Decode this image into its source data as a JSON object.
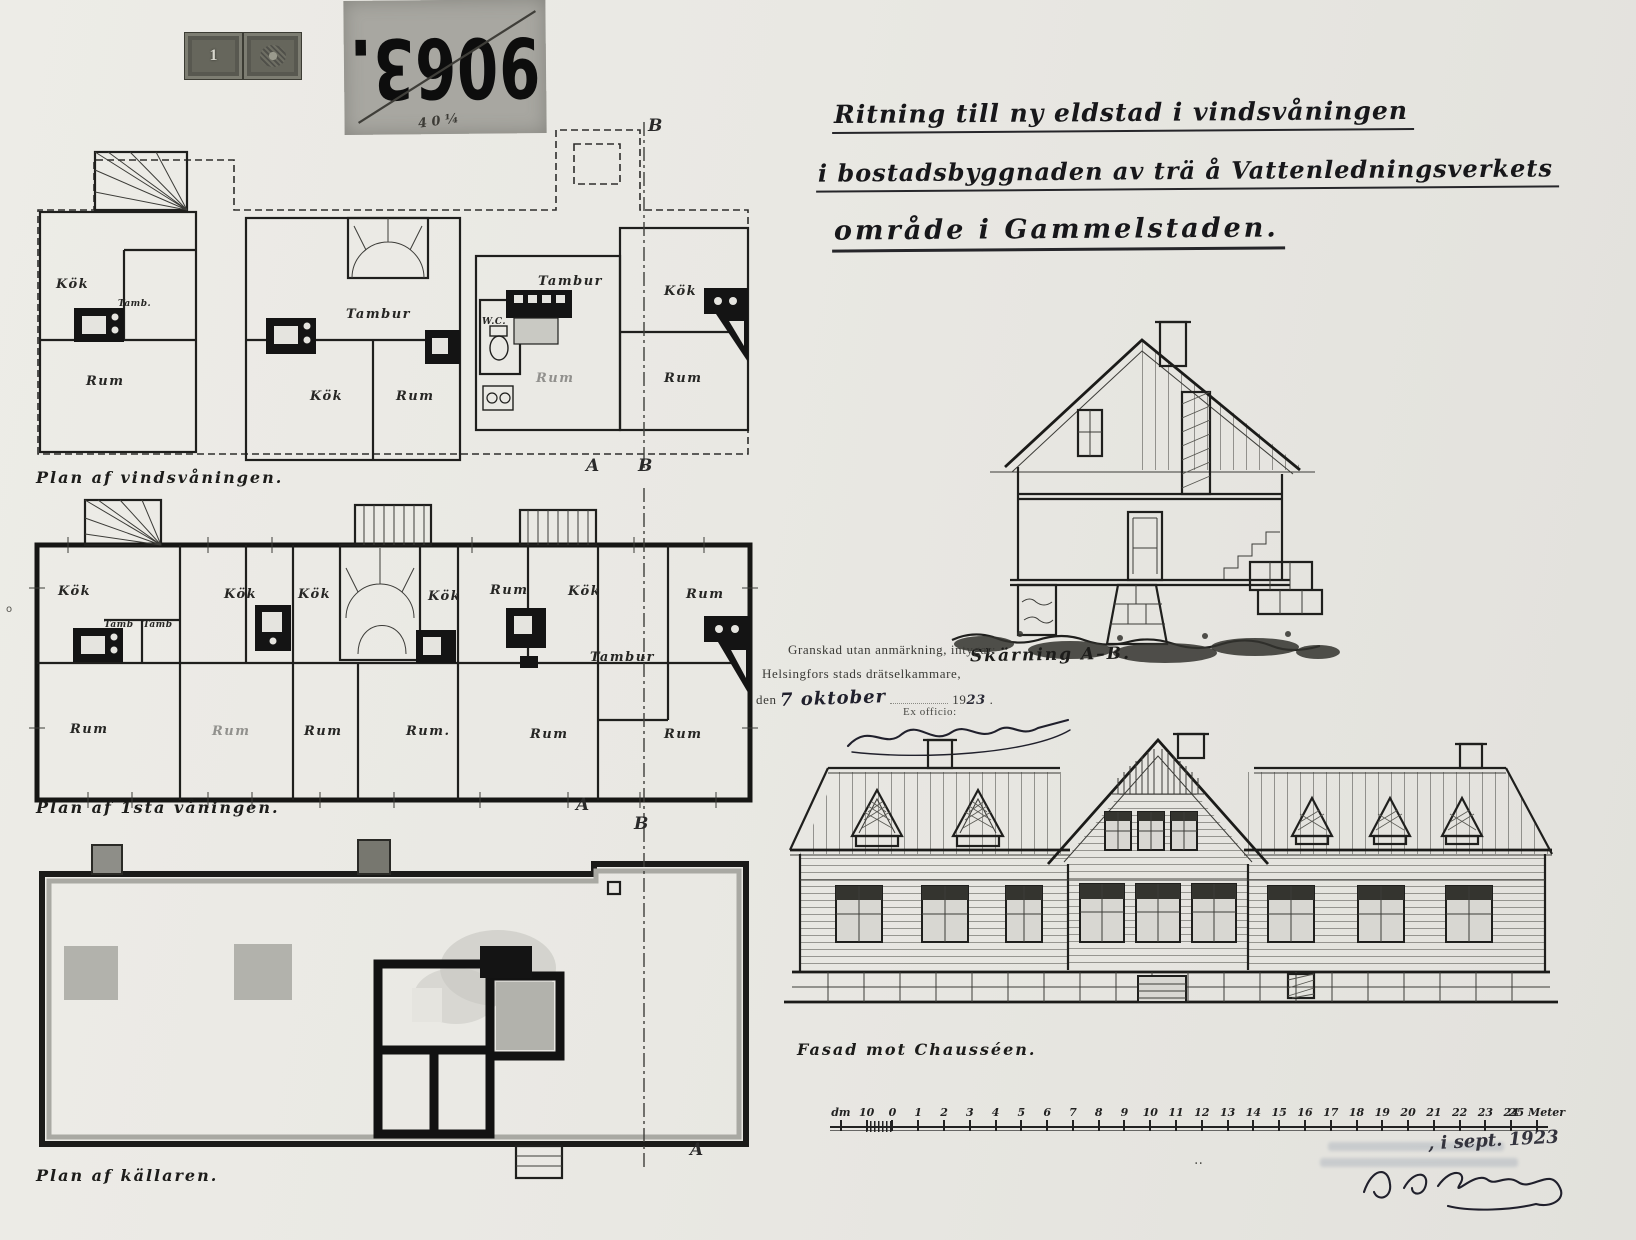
{
  "archive": {
    "number": "9063.",
    "scribble": "4 0 ¼",
    "revenue_stamp_value": "1"
  },
  "title": {
    "line1": "Ritning till ny eldstad i vindsvåningen",
    "line2": "i bostadsbyggnaden av trä å Vattenledningsverkets",
    "line3": "område i Gammelstaden."
  },
  "plans": {
    "attic": {
      "caption": "Plan af vindsvåningen.",
      "labels": {
        "kok1": "Kök",
        "tamb": "Tamb.",
        "rum1": "Rum",
        "tambur1": "Tambur",
        "kok2": "Kök",
        "rum2": "Rum",
        "tambur2": "Tambur",
        "wc": "W.C.",
        "rum3": "Rum",
        "kok3": "Kök",
        "rum4": "Rum"
      },
      "markers": {
        "b_top": "B",
        "a_bottom": "A",
        "b_bottom": "B"
      }
    },
    "first": {
      "caption": "Plan af 1sta våningen.",
      "labels": {
        "kok1": "Kök",
        "tamb1": "Tamb",
        "tamb2": "Tamb",
        "kok2": "Kök",
        "kok3": "Kök",
        "kok4": "Kök",
        "rum_t": "Rum",
        "kok5": "Kök",
        "rum_r": "Rum",
        "tambur": "Tambur",
        "rum1": "Rum",
        "rum2": "Rum",
        "rum3": "Rum",
        "rum4": "Rum.",
        "rum5": "Rum",
        "rum6": "Rum"
      },
      "markers": {
        "a_bottom": "A"
      }
    },
    "cellar": {
      "caption": "Plan af källaren.",
      "markers": {
        "b_top": "B",
        "a_bottom": "A"
      }
    }
  },
  "section": {
    "caption": "Skärning A–B."
  },
  "facade": {
    "caption": "Fasad mot Chausséen."
  },
  "approval": {
    "line1": "Granskad utan anmärkning, intygar:",
    "line2": "Helsingfors stads drätselkammare,",
    "den": "den",
    "date_handwritten": "7 oktober",
    "year_printed": "19",
    "year_handwritten": "23",
    "period": ".",
    "ex_officio": "Ex officio:"
  },
  "scale_bar": {
    "labels": [
      "dm",
      "10",
      "0",
      "1",
      "2",
      "3",
      "4",
      "5",
      "6",
      "7",
      "8",
      "9",
      "10",
      "11",
      "12",
      "13",
      "14",
      "15",
      "16",
      "17",
      "18",
      "19",
      "20",
      "21",
      "22",
      "23",
      "24",
      "25 Meter"
    ]
  },
  "footer": {
    "date_note": ", i sept. 1923",
    "mark": ".."
  }
}
